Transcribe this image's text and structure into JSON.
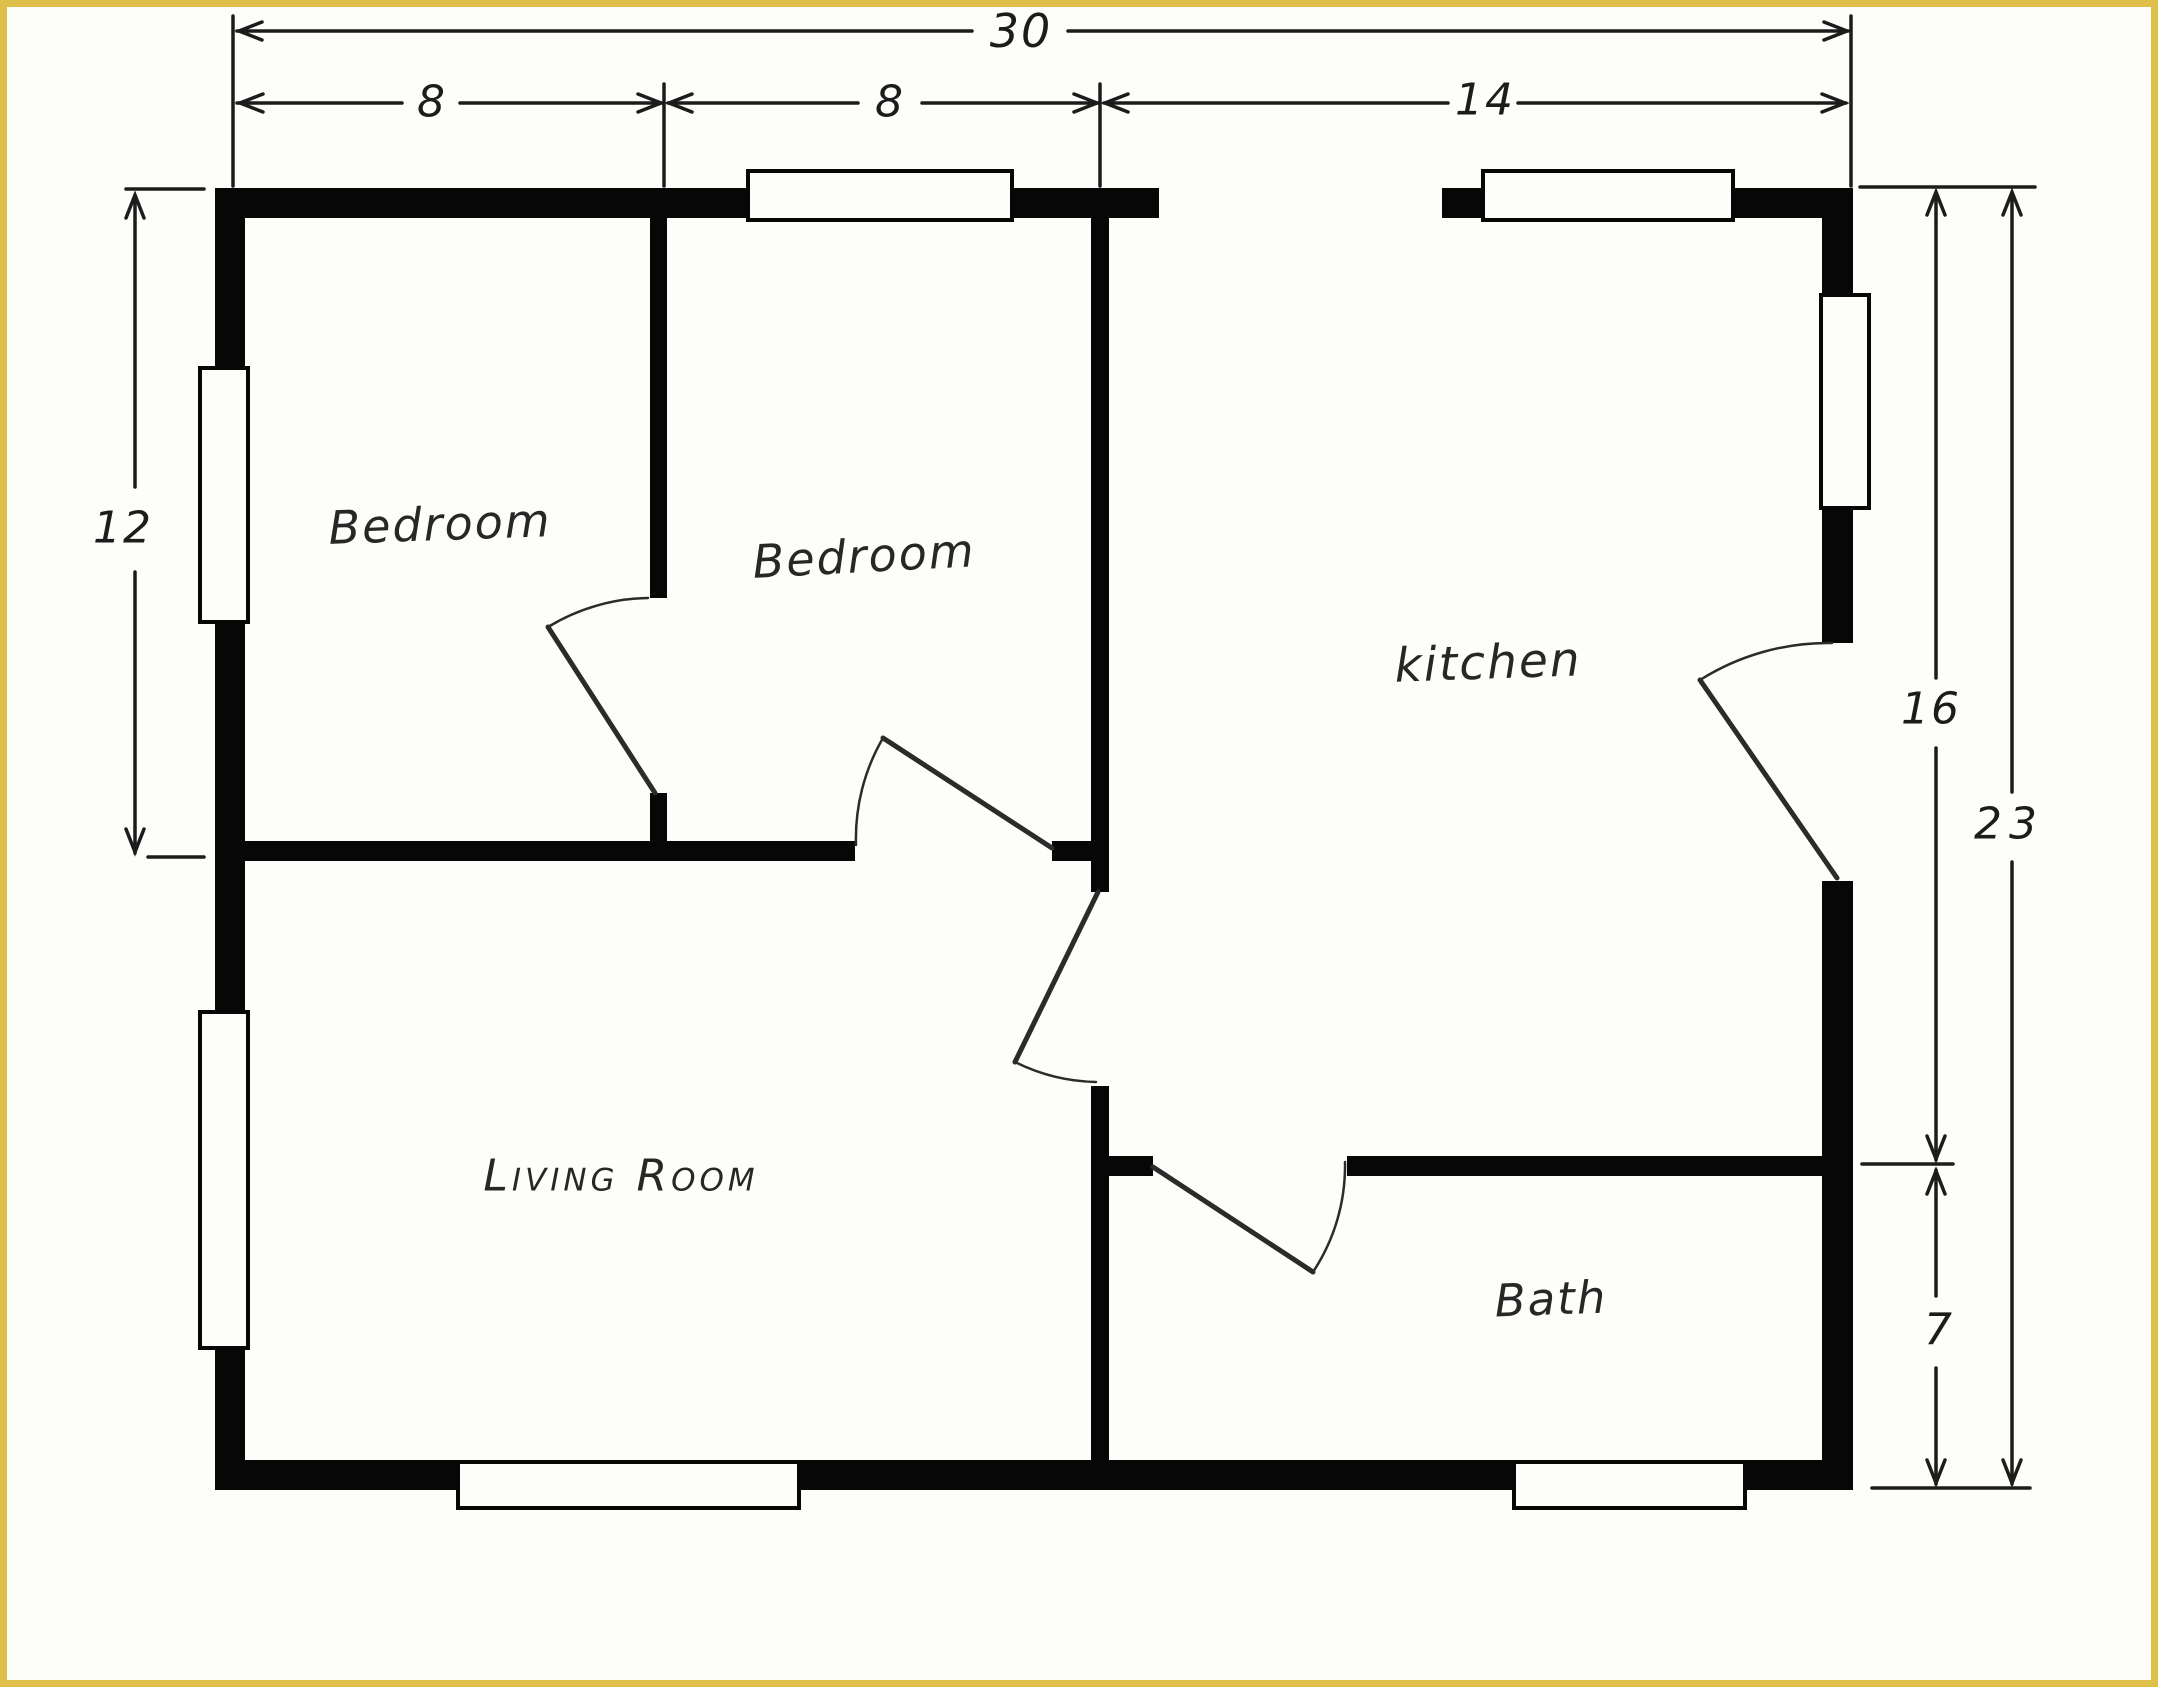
{
  "plan_type": "floor-plan-sketch",
  "rooms": {
    "bedroom1": "Bedroom",
    "bedroom2": "Bedroom",
    "kitchen": "kitchen",
    "living_room": "Living Room",
    "bath": "Bath"
  },
  "dimensions": {
    "total_width_ft": "30",
    "bedroom1_width_ft": "8",
    "bedroom2_width_ft": "8",
    "kitchen_width_ft": "14",
    "bedrooms_depth_ft": "12",
    "kitchen_depth_ft": "16",
    "total_depth_ft": "23",
    "bath_depth_ft": "7"
  },
  "colors": {
    "frame_border": "#ddbf4a",
    "walls": "#070707",
    "ink": "#1c1c1c",
    "paper": "#fdfdfa"
  },
  "features": {
    "windows": 7,
    "doors": 5
  }
}
